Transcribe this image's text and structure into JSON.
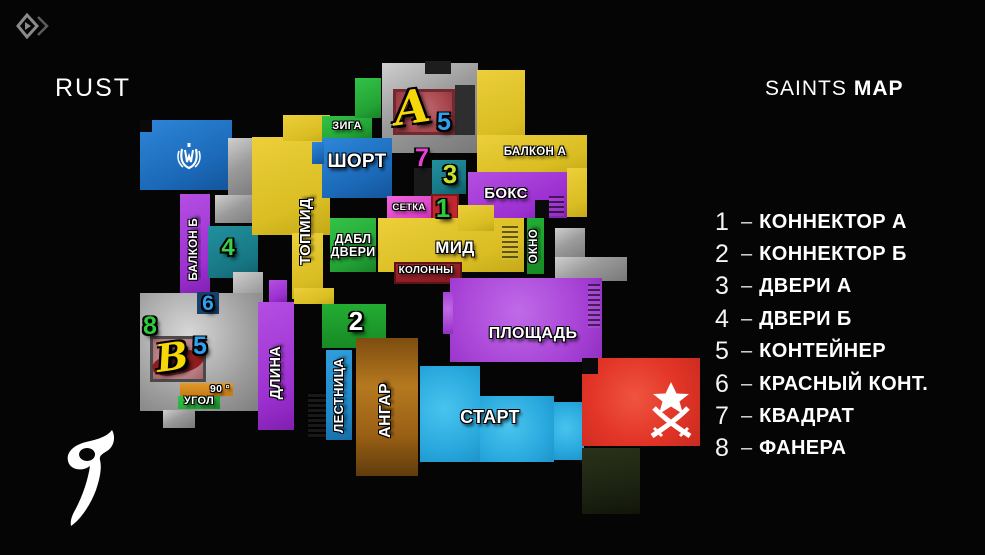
{
  "header": {
    "map_title": "RUST",
    "brand_light": "SAINTS",
    "brand_bold": "MAP"
  },
  "legend": {
    "dash": "–",
    "items": [
      {
        "num": "1",
        "name": "КОННЕКТОР А"
      },
      {
        "num": "2",
        "name": "КОННЕКТОР Б"
      },
      {
        "num": "3",
        "name": "ДВЕРИ А"
      },
      {
        "num": "4",
        "name": "ДВЕРИ Б"
      },
      {
        "num": "5",
        "name": "КОНТЕЙНЕР"
      },
      {
        "num": "6",
        "name": "КРАСНЫЙ КОНТ."
      },
      {
        "num": "7",
        "name": "КВАДРАТ"
      },
      {
        "num": "8",
        "name": "ФАНЕРА"
      }
    ]
  },
  "map": {
    "labels": {
      "ziga": "ЗИГА",
      "short": "ШОРТ",
      "topmid": "ТОПМИД",
      "balkon_a": "БАЛКОН А",
      "boks": "БОКС",
      "setka": "СЕТКА",
      "dabl_dveri": "ДАБЛ ДВЕРИ",
      "mid": "МИД",
      "kolonny": "КОЛОННЫ",
      "okno": "ОКНО",
      "balkon_b": "БАЛКОН Б",
      "ploshchad": "ПЛОЩАДЬ",
      "dlina": "ДЛИНА",
      "lestnitsa": "ЛЕСТНИЦА",
      "angar": "АНГАР",
      "start": "СТАРТ",
      "ugol": "УГОЛ",
      "angle": "90 °"
    },
    "sites": {
      "a": "A",
      "b": "B"
    },
    "markers": {
      "m1": "1",
      "m2": "2",
      "m3": "3",
      "m4": "4",
      "m5a": "5",
      "m5b": "5",
      "m6": "6",
      "m7": "7",
      "m8": "8"
    },
    "icons": {
      "corner": "diamond-logo-icon",
      "ct": "ct-emblem-icon",
      "t": "t-emblem-icon",
      "saints": "saints-s-logo-icon"
    },
    "colors": {
      "background": "#050505",
      "yellow": "#dfc22b",
      "blue": "#1d72c4",
      "light_blue": "#2fb0e4",
      "lestnitsa_blue": "#1f8ed2",
      "teal": "#1b7f8e",
      "green": "#28b43b",
      "dark_green": "#1c9e2c",
      "purple": "#a238d6",
      "ploshchad_purple": "#a84fd9",
      "magenta": "#e44fd2",
      "red": "#e63b2d",
      "brick": "#a9484e",
      "box_red": "#c02730",
      "dark_red": "#8e2026",
      "brown": "#b06d1e",
      "orange": "#d8891f",
      "gray": "#9a9a9a",
      "marker_blue": "#2da1f2",
      "marker_green": "#2ecb3f",
      "marker_magenta": "#e93fd9",
      "marker_lime": "#c3e32c",
      "site_yellow": "#f6d707"
    }
  }
}
